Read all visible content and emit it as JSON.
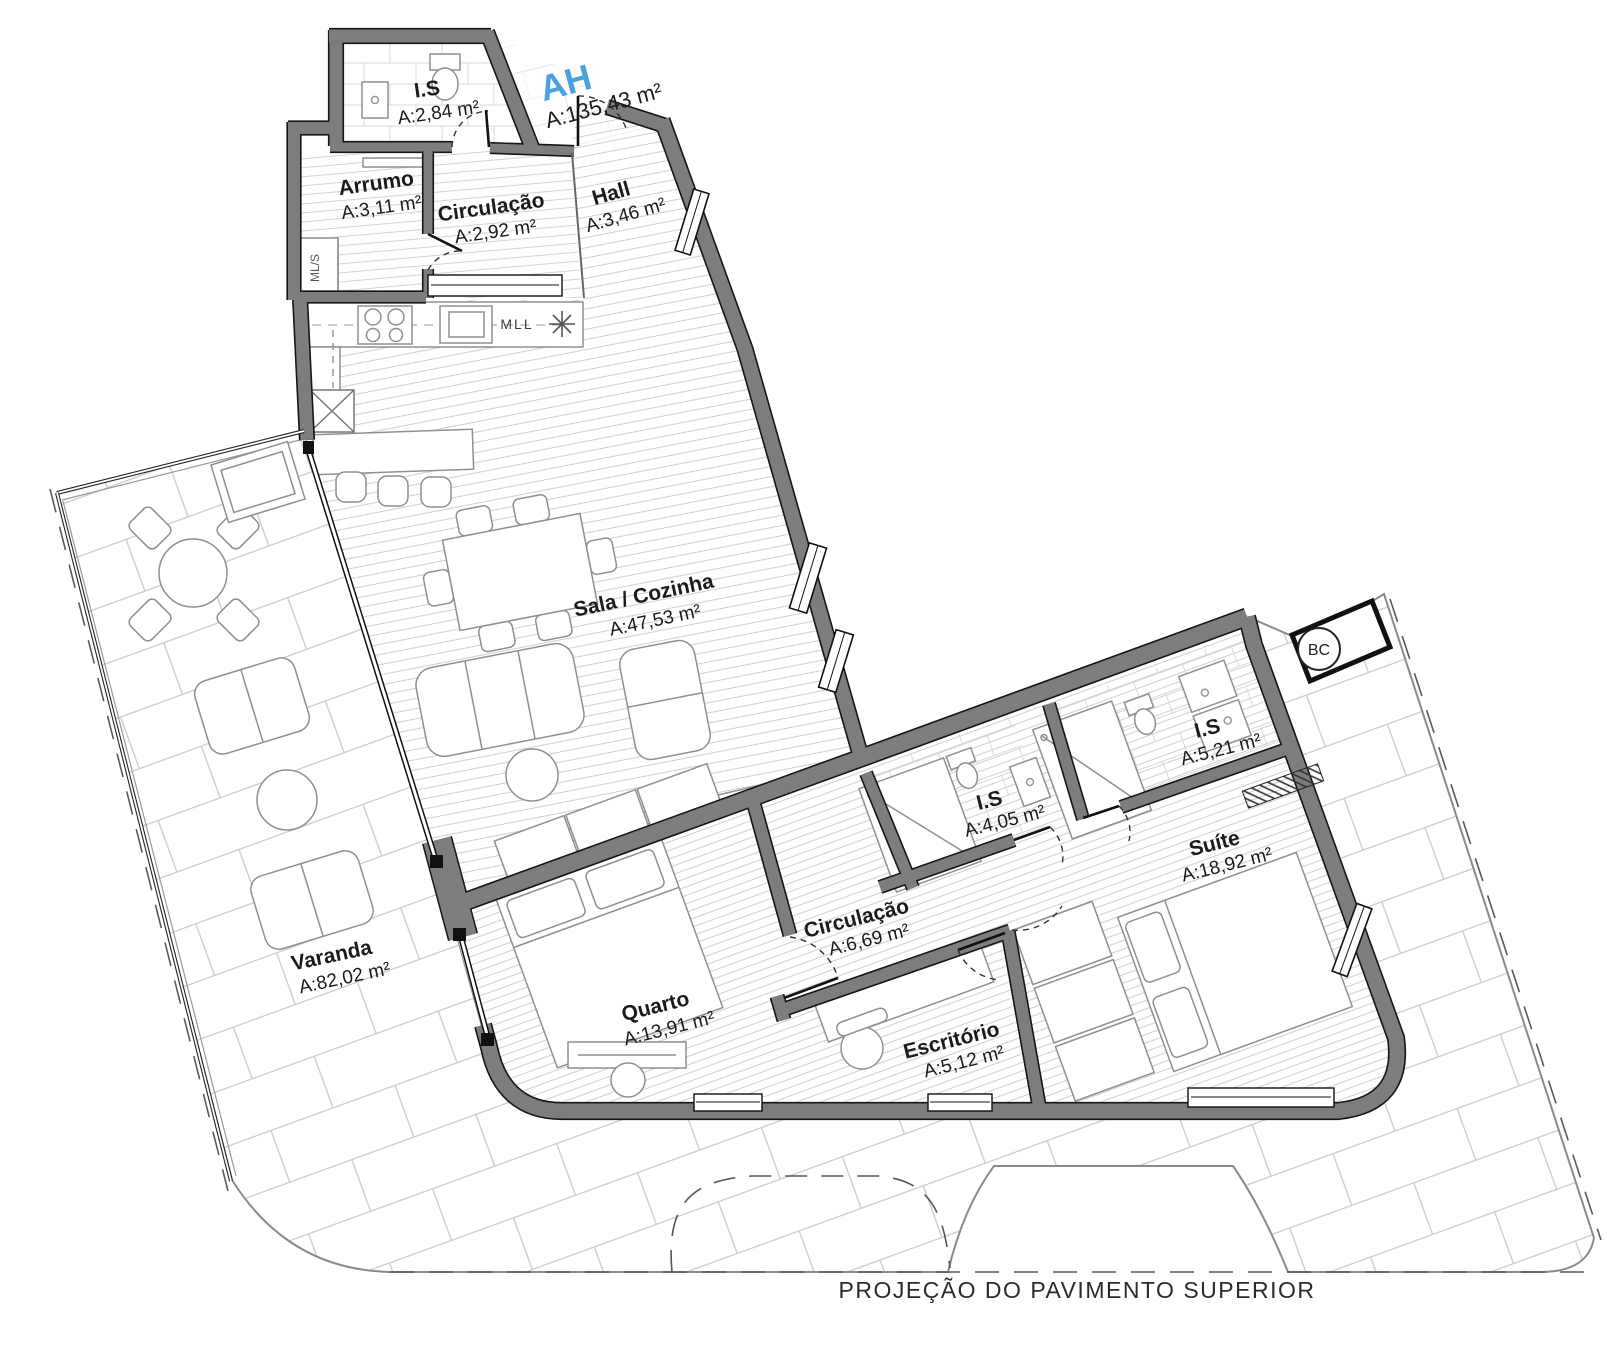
{
  "unit": {
    "code": "AH",
    "area": "A:135,43 m²",
    "accent_color": "#4aa1dd"
  },
  "rooms": [
    {
      "id": "is-superior",
      "name": "I.S",
      "area": "A:2,84 m²"
    },
    {
      "id": "arrumo",
      "name": "Arrumo",
      "area": "A:3,11 m²"
    },
    {
      "id": "circulacao-1",
      "name": "Circulação",
      "area": "A:2,92 m²"
    },
    {
      "id": "hall",
      "name": "Hall",
      "area": "A:3,46 m²"
    },
    {
      "id": "sala-cozinha",
      "name": "Sala / Cozinha",
      "area": "A:47,53 m²"
    },
    {
      "id": "varanda",
      "name": "Varanda",
      "area": "A:82,02 m²"
    },
    {
      "id": "quarto",
      "name": "Quarto",
      "area": "A:13,91 m²"
    },
    {
      "id": "circulacao-2",
      "name": "Circulação",
      "area": "A:6,69 m²"
    },
    {
      "id": "is-meio",
      "name": "I.S",
      "area": "A:4,05 m²"
    },
    {
      "id": "escritorio",
      "name": "Escritório",
      "area": "A:5,12 m²"
    },
    {
      "id": "is-suite",
      "name": "I.S",
      "area": "A:5,21 m²"
    },
    {
      "id": "suite",
      "name": "Suíte",
      "area": "A:18,92 m²"
    }
  ],
  "labels": {
    "washer_dryer": "ML/S",
    "dishwasher": "MLL",
    "duct": "BC",
    "footer_note": "PROJEÇÃO DO PAVIMENTO SUPERIOR"
  },
  "colors": {
    "wall_fill": "#7d7d7d",
    "wall_edge": "#161616",
    "hatch_line": "#cfcfcf",
    "tile_line": "#c9c9c9",
    "furniture_line": "#8f8f8f"
  }
}
